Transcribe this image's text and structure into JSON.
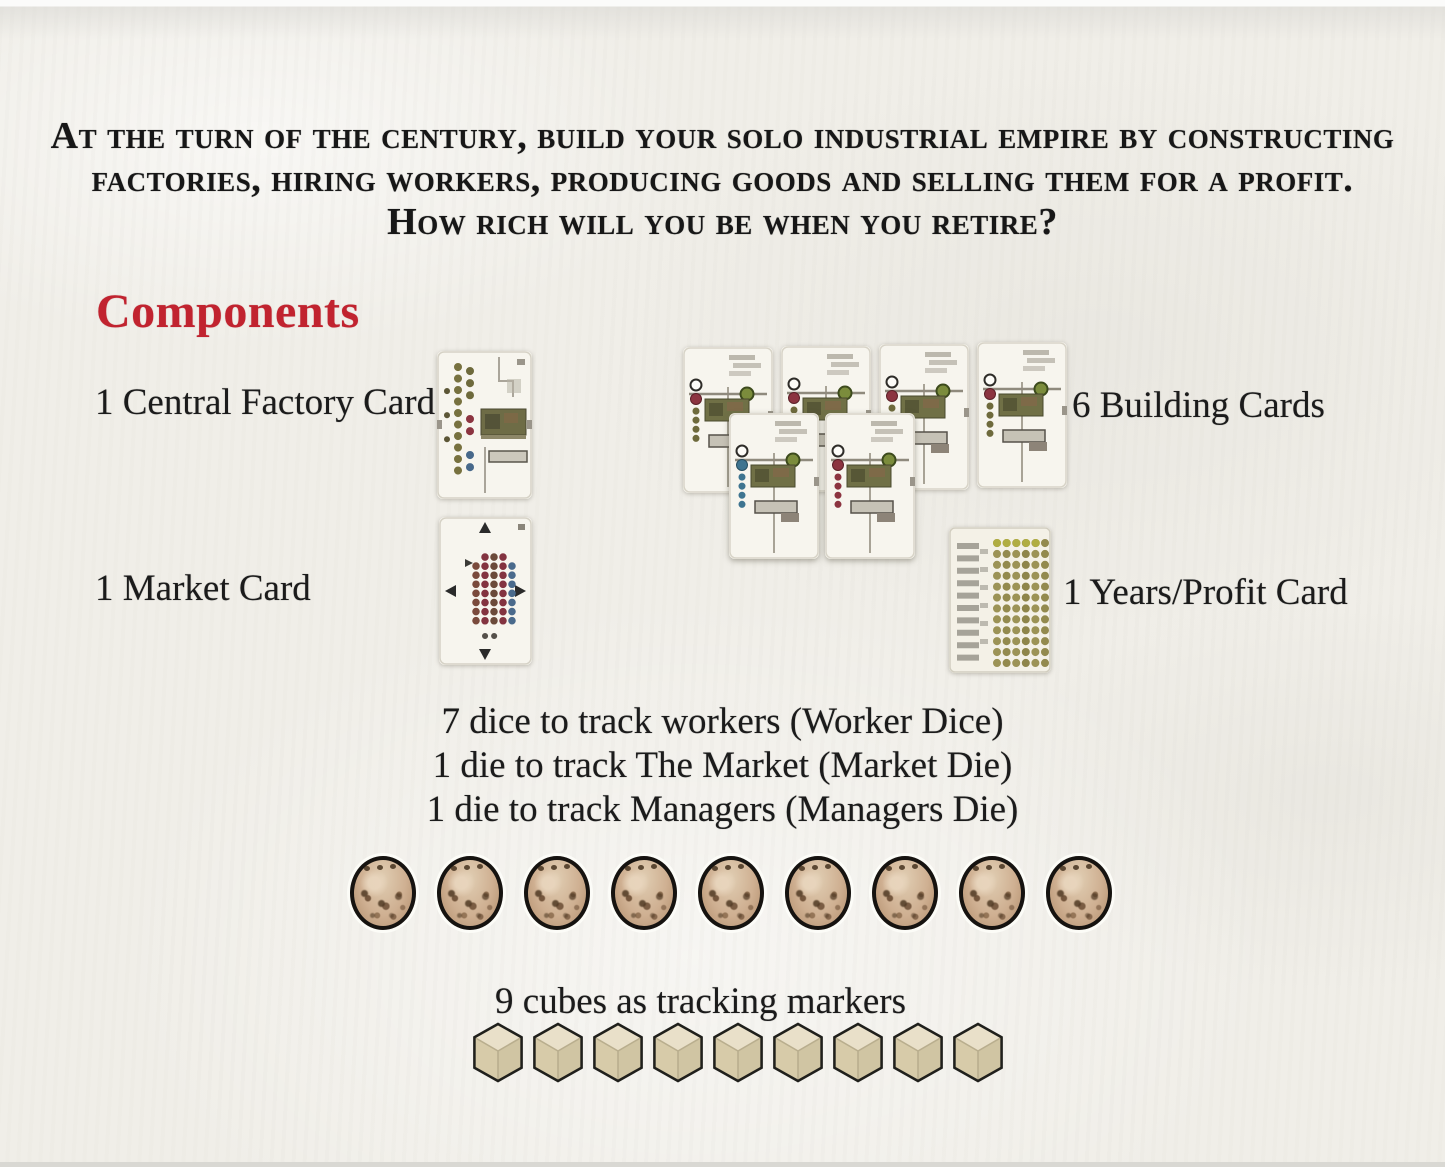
{
  "intro": {
    "line1": "At the turn of the century, build your solo industrial empire by constructing",
    "line2": "factories, hiring workers, producing goods and selling them for a profit.",
    "line3": "How rich will you be when you retire?"
  },
  "components": {
    "heading": "Components",
    "heading_color": "#c1232f",
    "items": [
      {
        "id": "central-factory-card",
        "label": "1 Central Factory Card"
      },
      {
        "id": "building-cards",
        "label": "6 Building Cards"
      },
      {
        "id": "market-card",
        "label": "1 Market Card"
      },
      {
        "id": "years-profit-card",
        "label": "1 Years/Profit Card"
      }
    ],
    "building_cards_count": 6,
    "dice_lines": [
      "7 dice to track workers (Worker Dice)",
      "1 die to track The Market (Market Die)",
      "1 die to track Managers (Managers Die)"
    ],
    "dice_count": 9,
    "cubes": {
      "label": "9 cubes as tracking markers",
      "count": 9
    }
  },
  "colors": {
    "page_background": "#f0eee8",
    "text": "#1b1b1b",
    "heading_red": "#c1232f",
    "die_body": "#cfb092",
    "cube_fill": "#ded3b4"
  }
}
